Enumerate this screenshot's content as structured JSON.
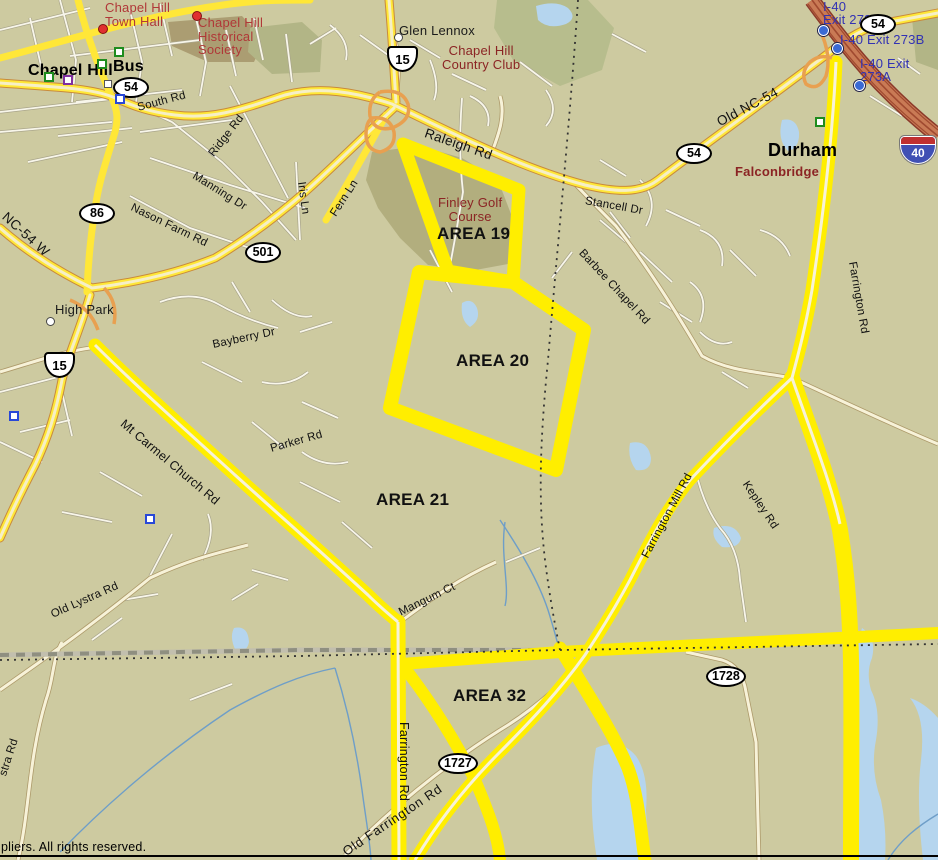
{
  "map": {
    "attribution": "pliers. All rights reserved.",
    "colors": {
      "background": "#cdcaa0",
      "highlight_route": "#ffee00",
      "major_road": "#ffe738",
      "interstate": "#c97a55",
      "water": "#b5d5ee",
      "poi_red": "#b03838",
      "poi_maroon": "#8b2424",
      "exit_text_blue": "#3232b4"
    },
    "labels": {
      "town_hall": "Chapel Hill\nTown Hall",
      "historical_society": "Chapel Hill\nHistorical\nSociety",
      "chapel_hill": "Chapel Hill",
      "bus": "Bus",
      "glen_lennox": "Glen Lennox",
      "country_club": "Chapel Hill\nCountry Club",
      "south_rd": "South Rd",
      "ridge_rd": "Ridge Rd",
      "manning_dr": "Manning Dr",
      "iris_ln": "Iris Ln",
      "fern_ln": "Fern Ln",
      "nason_farm_rd": "Nason Farm Rd",
      "raleigh_rd": "Raleigh Rd",
      "stancell_dr": "Stancell Dr",
      "old_nc54": "Old NC-54",
      "barbee_chapel_rd": "Barbee Chapel Rd",
      "farrington_rd_n": "Farrington Rd",
      "farrington_rd_s": "Farrington Rd",
      "farrington_mill_rd": "Farrington Mill Rd",
      "kepley_rd": "Kepley Rd",
      "mt_carmel_church_rd": "Mt Carmel Church Rd",
      "bayberry_dr": "Bayberry Dr",
      "parker_rd": "Parker Rd",
      "old_lystra_rd": "Old Lystra Rd",
      "lystra_rd_partial": "stra Rd",
      "mangum_ct": "Mangum Ct",
      "old_farrington_rd": "Old Farrington Rd",
      "nc54_w": "NC-54 W",
      "high_park": "High Park",
      "durham": "Durham",
      "falconbridge": "Falconbridge",
      "finley_golf_course": "Finley Golf\nCourse",
      "area_19": "AREA 19",
      "area_20": "AREA 20",
      "area_21": "AREA 21",
      "area_32": "AREA 32",
      "i40_exit_273": "I-40\nExit 273",
      "i40_exit_273b": "I-40 Exit 273B",
      "i40_exit_273a": "I-40 Exit\n273A"
    },
    "shields": {
      "bus_54": "54",
      "nc_86": "86",
      "us_501": "501",
      "us_15_north": "15",
      "us_15_west": "15",
      "nc_54_mid": "54",
      "nc_54_topright": "54",
      "sr_1727": "1727",
      "sr_1728": "1728",
      "i_40": "40"
    }
  }
}
